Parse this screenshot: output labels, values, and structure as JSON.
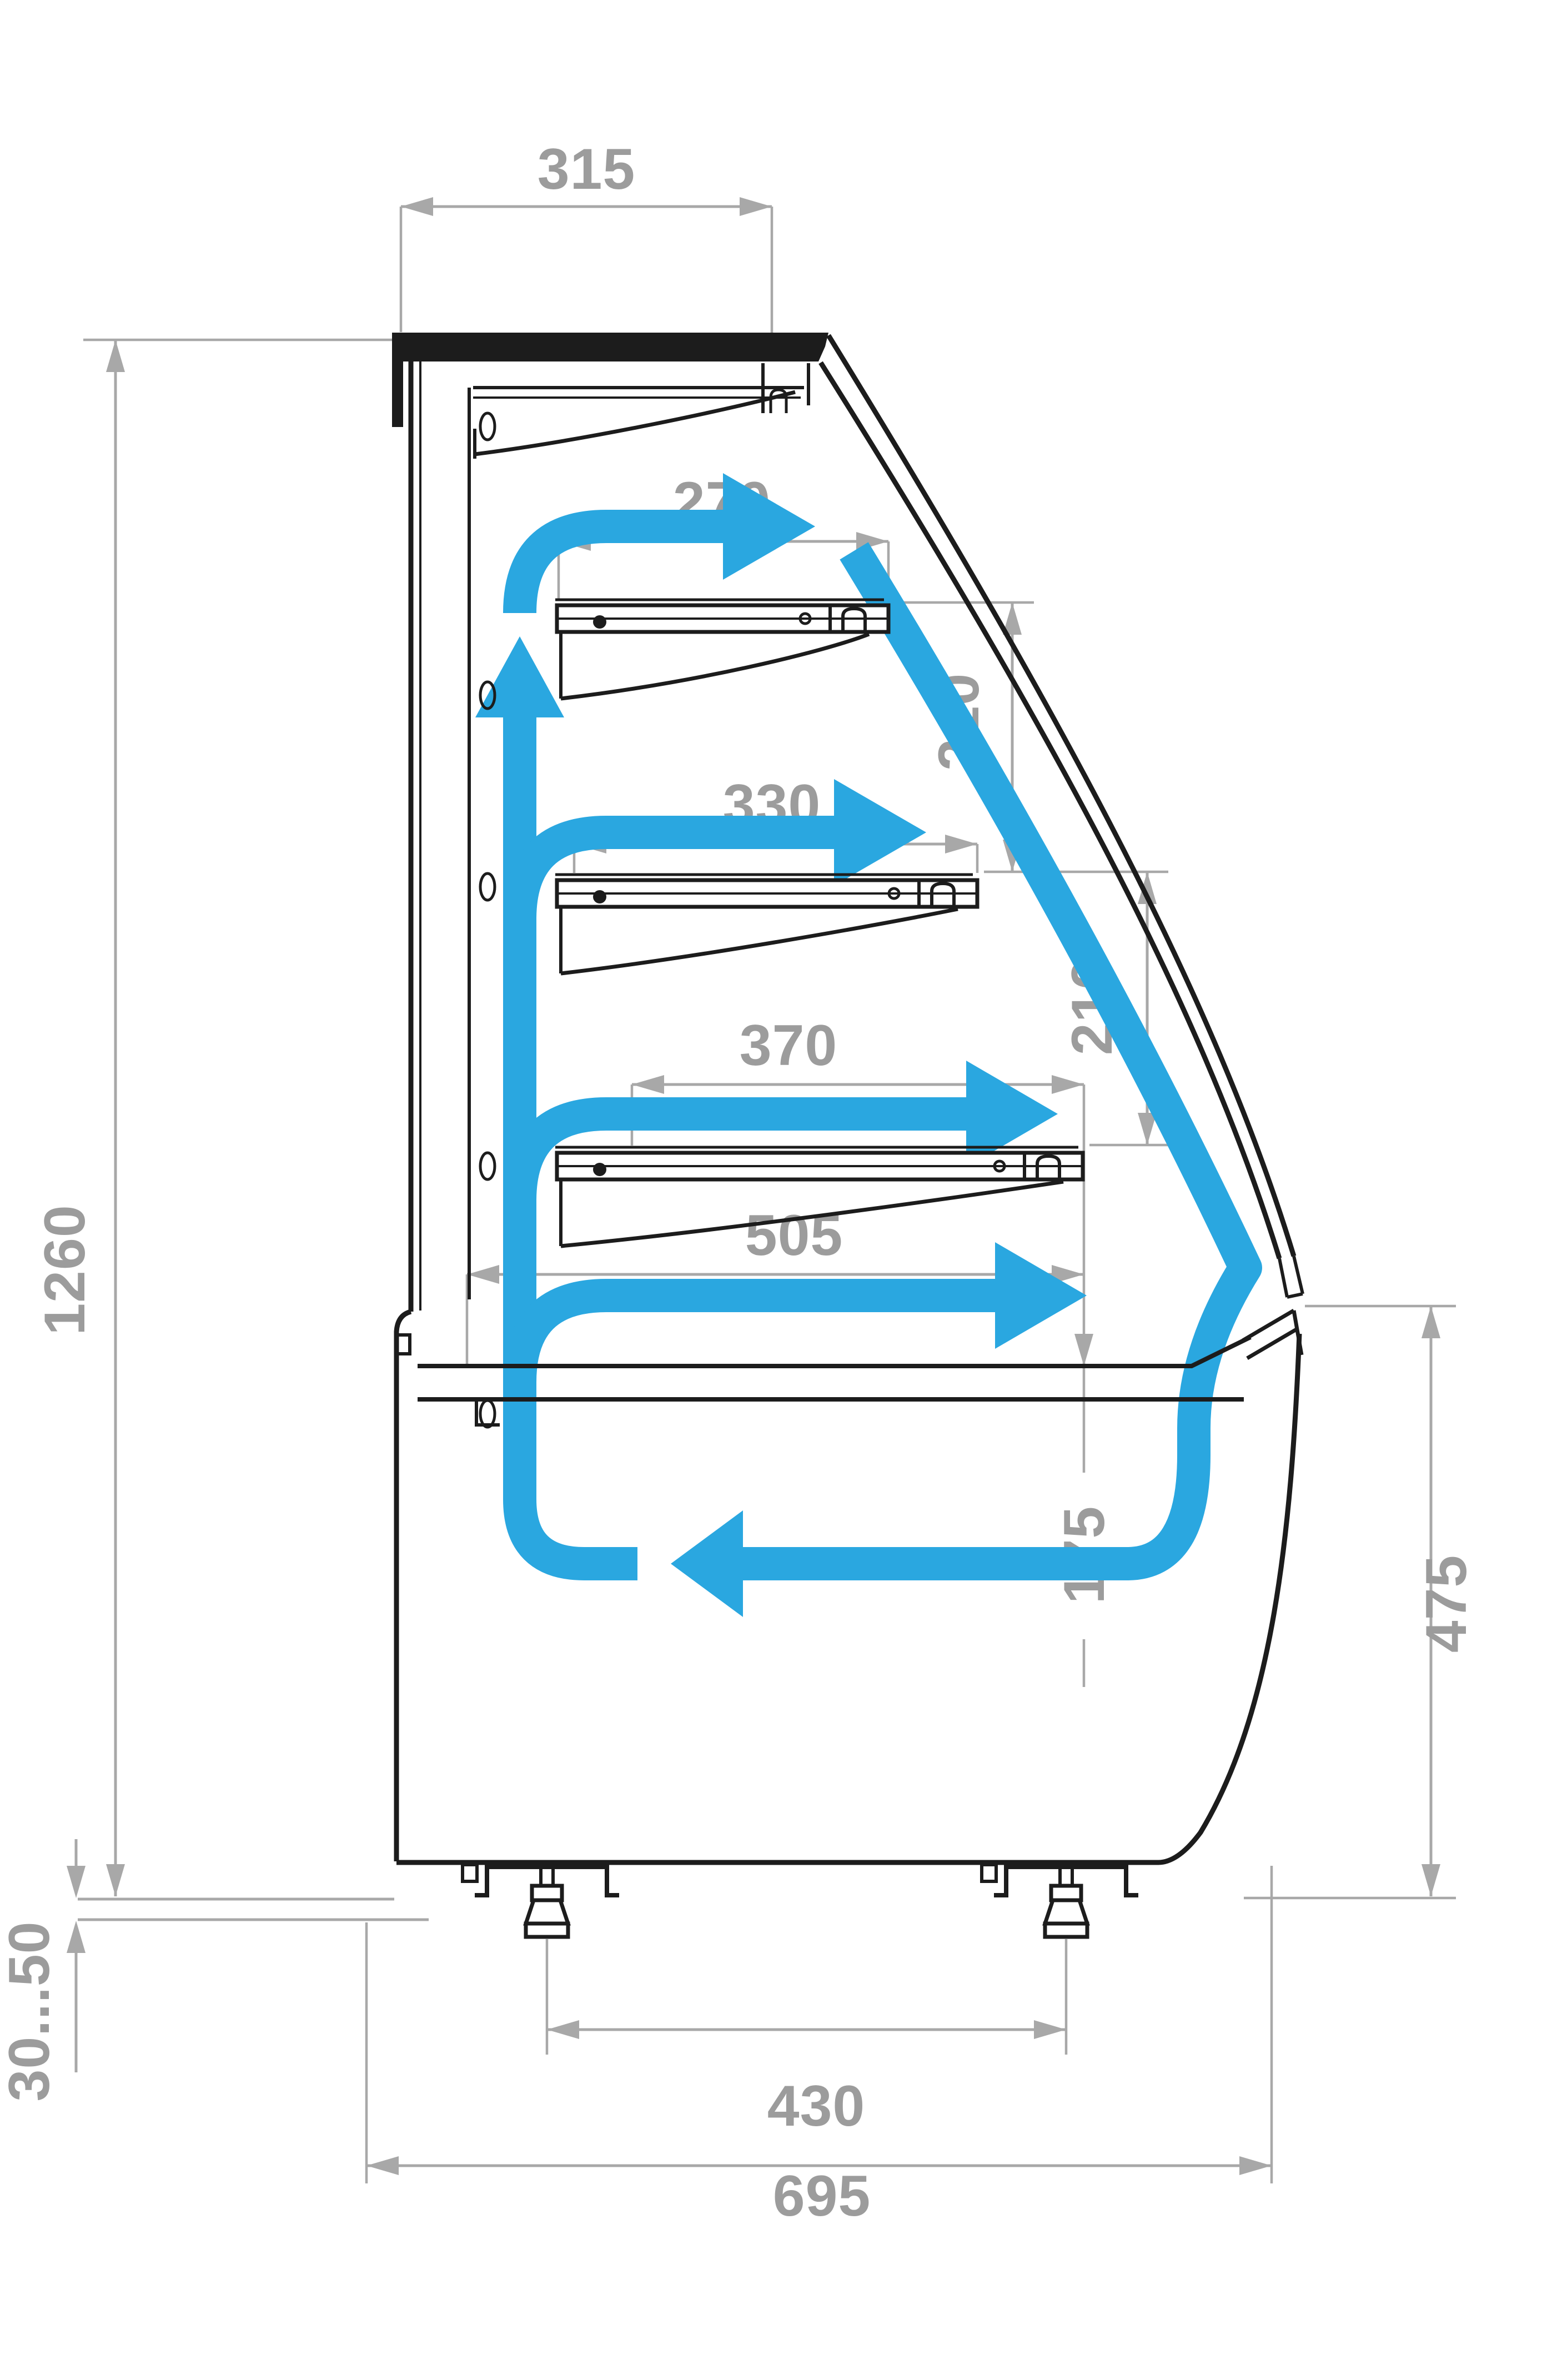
{
  "colors": {
    "line": "#1c1c1c",
    "dim": "#a8a8a8",
    "label": "#9c9c9c",
    "airflow": "#2aa7e0",
    "background": "#ffffff"
  },
  "diagram": {
    "type": "technical-drawing",
    "subject": "refrigerated-display-case-cross-section",
    "dimensions": {
      "canopy_depth": "315",
      "shelf1_depth": "270",
      "shelf2_depth": "330",
      "shelf3_depth": "370",
      "deck_depth": "505",
      "shelf_gap_upper": "210",
      "shelf_gap_lower": "210",
      "front_opening_height": "175",
      "body_height": "1260",
      "base_front_height": "475",
      "feet_spacing": "430",
      "total_depth": "695",
      "leg_adjust_range": "30...50"
    },
    "airflow_paths": [
      "back-duct-riser-arrow",
      "top-supply-arrow",
      "shelf1-supply-arrow",
      "shelf2-supply-arrow",
      "deck-supply-arrow",
      "glass-air-curtain-return-arrow"
    ]
  }
}
